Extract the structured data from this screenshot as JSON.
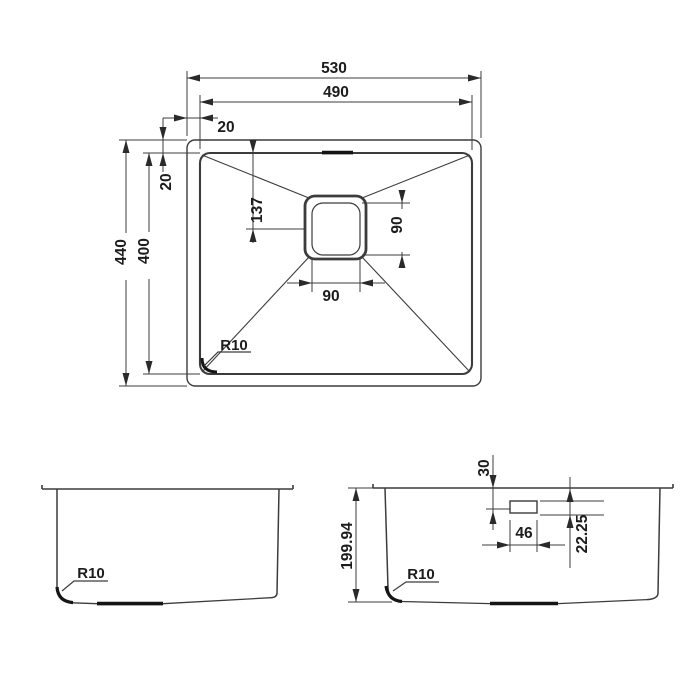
{
  "drawing": {
    "line_color": "#3c3c3c",
    "thick_color": "#151515",
    "top_view": {
      "width_outer": "530",
      "width_inner": "490",
      "offset_horizontal": "20",
      "offset_vertical": "20",
      "depth_outer": "440",
      "depth_inner": "400",
      "drain_center_from_back": "137",
      "drain_size_vertical": "90",
      "drain_size_horizontal": "90",
      "corner_radius": "R10"
    },
    "side_view": {
      "corner_radius": "R10"
    },
    "front_view": {
      "height": "199.94",
      "overflow_top_offset": "30",
      "overflow_width": "46",
      "overflow_depth": "22.25",
      "corner_radius": "R10"
    }
  }
}
